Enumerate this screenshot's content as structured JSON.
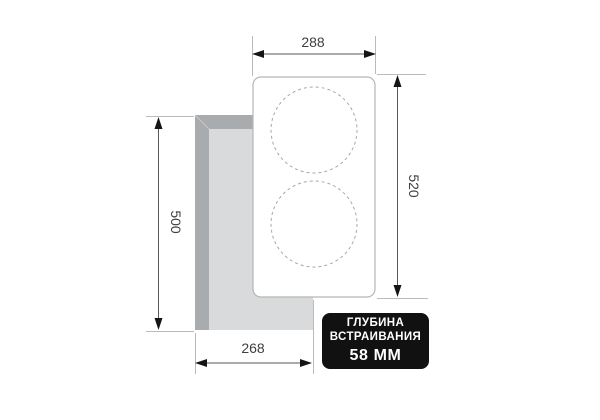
{
  "diagram": {
    "title_semantic": "cooktop-builtin-dimensions-drawing",
    "dimensions": {
      "top_width": "288",
      "right_height": "520",
      "left_height": "500",
      "bottom_width": "268"
    },
    "badge": {
      "line1": "ГЛУБИНА",
      "line2": "ВСТРАИВАНИЯ",
      "line3": "58 ММ"
    },
    "colors": {
      "background": "#ffffff",
      "cutout_wall_gray": "#a9acae",
      "cutout_floor_gray": "#d9dadc",
      "bevel_seam": "#c6c8ca",
      "cooktop_fill": "#ffffff",
      "cooktop_stroke": "#b4b6b8",
      "burner_dash": "#a6a8aa",
      "extension_line": "#b9bbbd",
      "dimension_line": "#58595b",
      "arrow": "#151515",
      "label_text": "#3d3f41",
      "badge_bg": "#111111",
      "badge_text": "#ffffff"
    }
  }
}
